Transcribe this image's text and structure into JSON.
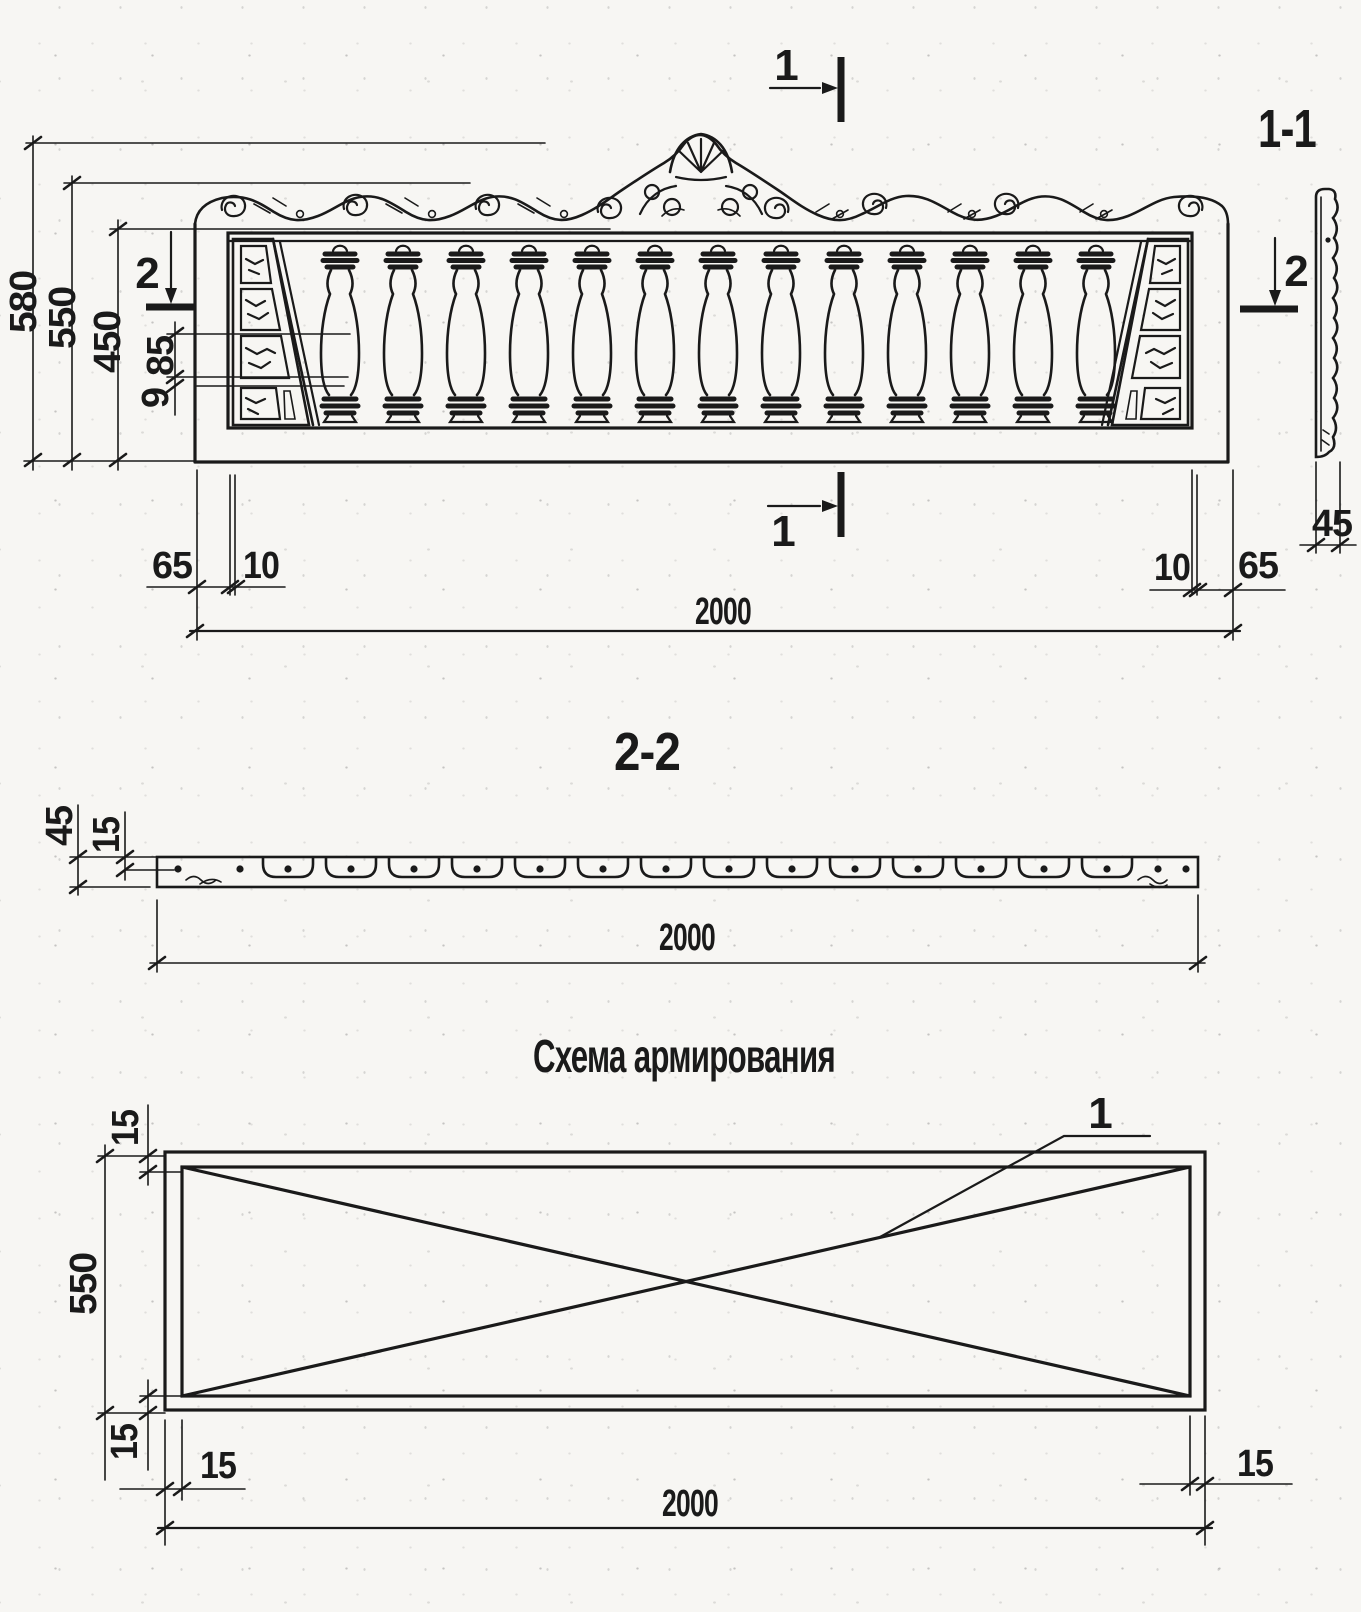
{
  "meta": {
    "paper_color": "#f7f6f3",
    "ink_color": "#1a1a1a"
  },
  "elevation": {
    "cut_top": "1",
    "cut_bottom": "1",
    "cut_left": "2",
    "cut_right": "2",
    "baluster_count": 13,
    "dims": {
      "total_height": "580",
      "panel_height": "550",
      "balustrade_height": "450",
      "corner_cell": "85",
      "corner_rib": "9",
      "edge_left": "65",
      "lip_left": "10",
      "lip_right": "10",
      "edge_right": "65",
      "length": "2000"
    }
  },
  "section_1_1": {
    "label": "1-1",
    "cut": "2",
    "dims": {
      "thickness": "45"
    }
  },
  "section_2_2": {
    "label": "2-2",
    "socket_count": 14,
    "dims": {
      "thickness": "45",
      "bar_depth": "15",
      "length": "2000"
    }
  },
  "reinforcement": {
    "title": "Схема армирования",
    "bar_label": "1",
    "dims": {
      "cover_top": "15",
      "height": "550",
      "cover_bottom": "15",
      "cover_left": "15",
      "cover_right": "15",
      "length": "2000"
    }
  }
}
